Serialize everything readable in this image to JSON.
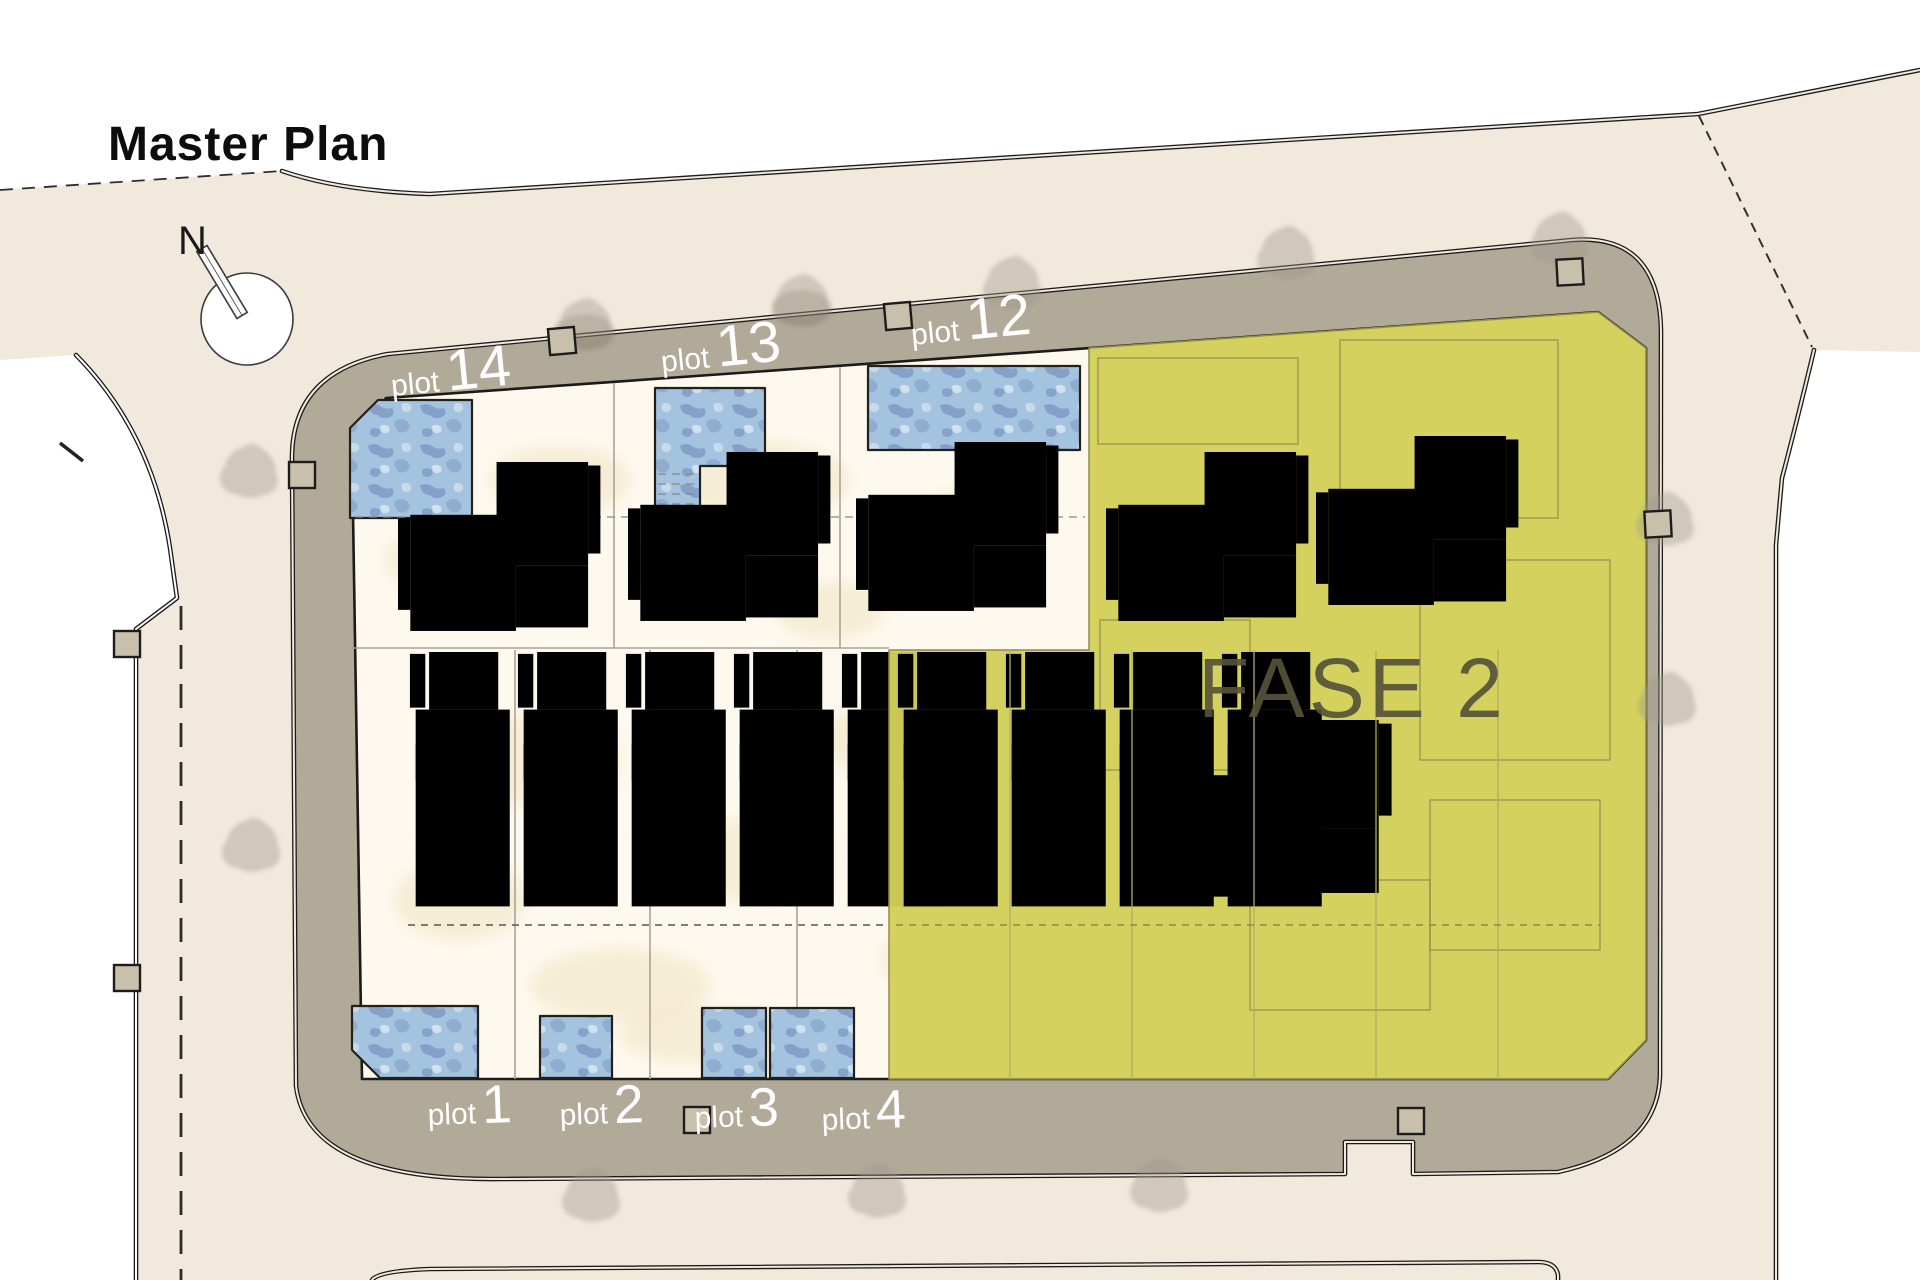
{
  "title": "Master Plan",
  "compass": {
    "label": "N"
  },
  "phase": {
    "label": "FASE 2"
  },
  "plots": {
    "top": [
      {
        "prefix": "plot",
        "number": "14"
      },
      {
        "prefix": "plot",
        "number": "13"
      },
      {
        "prefix": "plot",
        "number": "12"
      }
    ],
    "bottom": [
      {
        "prefix": "plot",
        "number": "1"
      },
      {
        "prefix": "plot",
        "number": "2"
      },
      {
        "prefix": "plot",
        "number": "3"
      },
      {
        "prefix": "plot",
        "number": "4"
      }
    ]
  },
  "colors": {
    "site_beige": "#f2e9dd",
    "road_gray": "#b2aa99",
    "parcel_cream": "#fdf9ee",
    "phase_yellow": "#d2cf58",
    "pool_blue": "#a3c3de",
    "label_white": "#fefefe",
    "phase_text": "#55533a"
  }
}
